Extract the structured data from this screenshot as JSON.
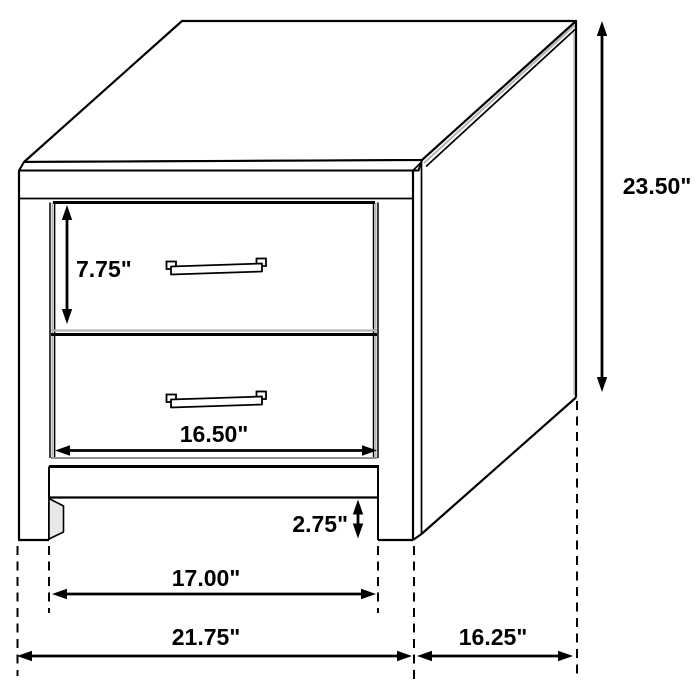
{
  "diagram": {
    "subject": "two-drawer nightstand line drawing",
    "view": "three-quarter front-right perspective",
    "style": {
      "background": "#ffffff",
      "line_color": "#000000",
      "shade_color": "#b5b5b5"
    },
    "labels": {
      "height": "23.50\"",
      "drawer_height": "7.75\"",
      "drawer_width": "16.50\"",
      "clearance": "2.75\"",
      "inner_width": "17.00\"",
      "overall_width": "21.75\"",
      "depth": "16.25\""
    }
  }
}
